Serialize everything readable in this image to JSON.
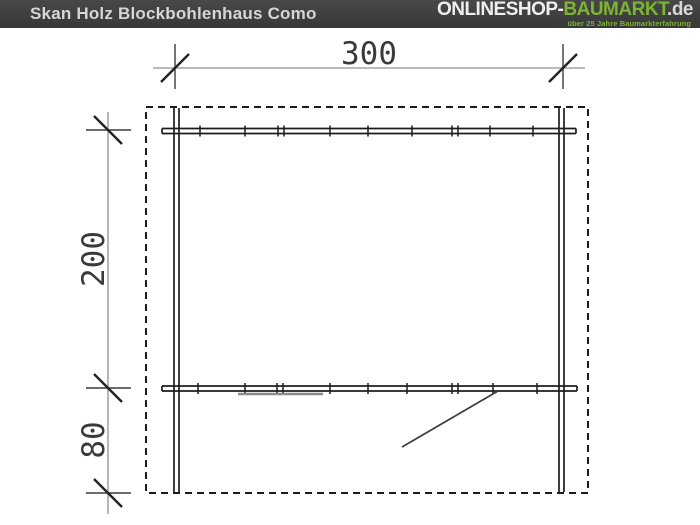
{
  "header": {
    "title": "Skan Holz Blockbohlenhaus Como",
    "logo": {
      "part_shop": "ONLINESHOP-",
      "part_brand": "BAUMARKT",
      "part_tld": ".de",
      "tagline": "über 25 Jahre Baumarkterfahrung"
    }
  },
  "drawing": {
    "type": "floor_plan_diagram",
    "product": "Skan Holz Blockbohlenhaus Como",
    "dimensions": {
      "width_label": "300",
      "depth_label": "200",
      "porch_depth_label": "80"
    },
    "features": [
      "dashed roof outline",
      "log side walls",
      "back wall",
      "front wall with window",
      "door swing in porch area"
    ],
    "colors": {
      "header_bg": "#3f3f3f",
      "accent_green": "#7cb52f",
      "wall_line": "#1d1d1d",
      "dim_line": "#909090",
      "window_line": "#8a8a8a"
    }
  }
}
